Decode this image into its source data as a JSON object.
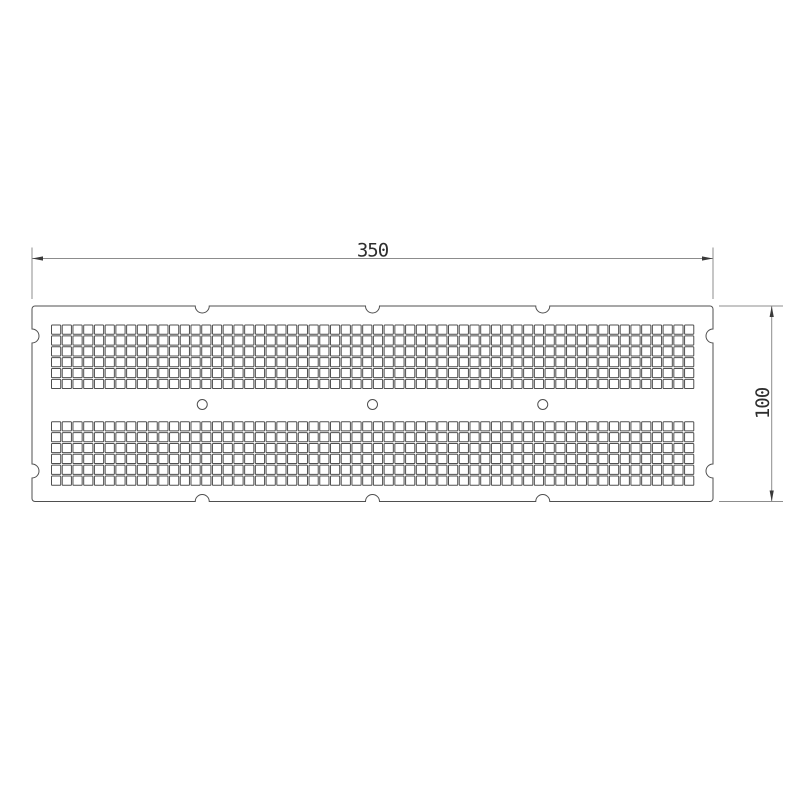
{
  "title": "Perforated plate technical drawing",
  "dimensions": {
    "width": {
      "label": "350"
    },
    "height": {
      "label": "100"
    }
  },
  "colors": {
    "background": "#ffffff",
    "outline": "#4f4f4f",
    "hole_fill": "#ffffff",
    "dimension_line": "#8c8c8c",
    "dimension_text": "#2e2e2e",
    "arrow": "#3a3a3a"
  },
  "drawing": {
    "canvas": {
      "width": 800,
      "height": 800
    },
    "plate": {
      "x": 32,
      "y": 306,
      "width": 681,
      "height": 195.5,
      "corner_radius": 3,
      "stroke_width": 1
    },
    "edge_notches": {
      "radius": 7,
      "top_x": [
        202.25,
        372.5,
        542.75
      ],
      "bottom_x": [
        202.25,
        372.5,
        542.75
      ],
      "left_y": [
        336,
        471
      ],
      "right_y": [
        336,
        471
      ]
    },
    "square_holes": {
      "columns": 60,
      "rows_per_band": 6,
      "pitch_x": 10.73,
      "pitch_y": 10.87,
      "size": 9.2,
      "start_x": 51.5,
      "band_top_y": [
        325.0,
        421.7
      ],
      "corner_radius": 0.8,
      "stroke_width": 1
    },
    "round_holes": {
      "radius": 5,
      "center_y": 404.5,
      "center_x": [
        202.25,
        372.5,
        542.75
      ],
      "stroke_width": 1
    },
    "width_dimension": {
      "line_y": 258.5,
      "from_x": 32,
      "to_x": 713,
      "ext_line_top_y": 247.5,
      "ext_line_bottom_y": 299,
      "label_anchor_x": 372.5,
      "label_baseline_y": 256.5
    },
    "height_dimension": {
      "line_x": 771.7,
      "from_y": 306,
      "to_y": 501.5,
      "ext_line_left_x": 719,
      "ext_line_right_x": 783,
      "label_anchor_x": 769,
      "label_anchor_y": 403.5
    },
    "arrow": {
      "length": 11,
      "half_width": 2.1
    }
  }
}
